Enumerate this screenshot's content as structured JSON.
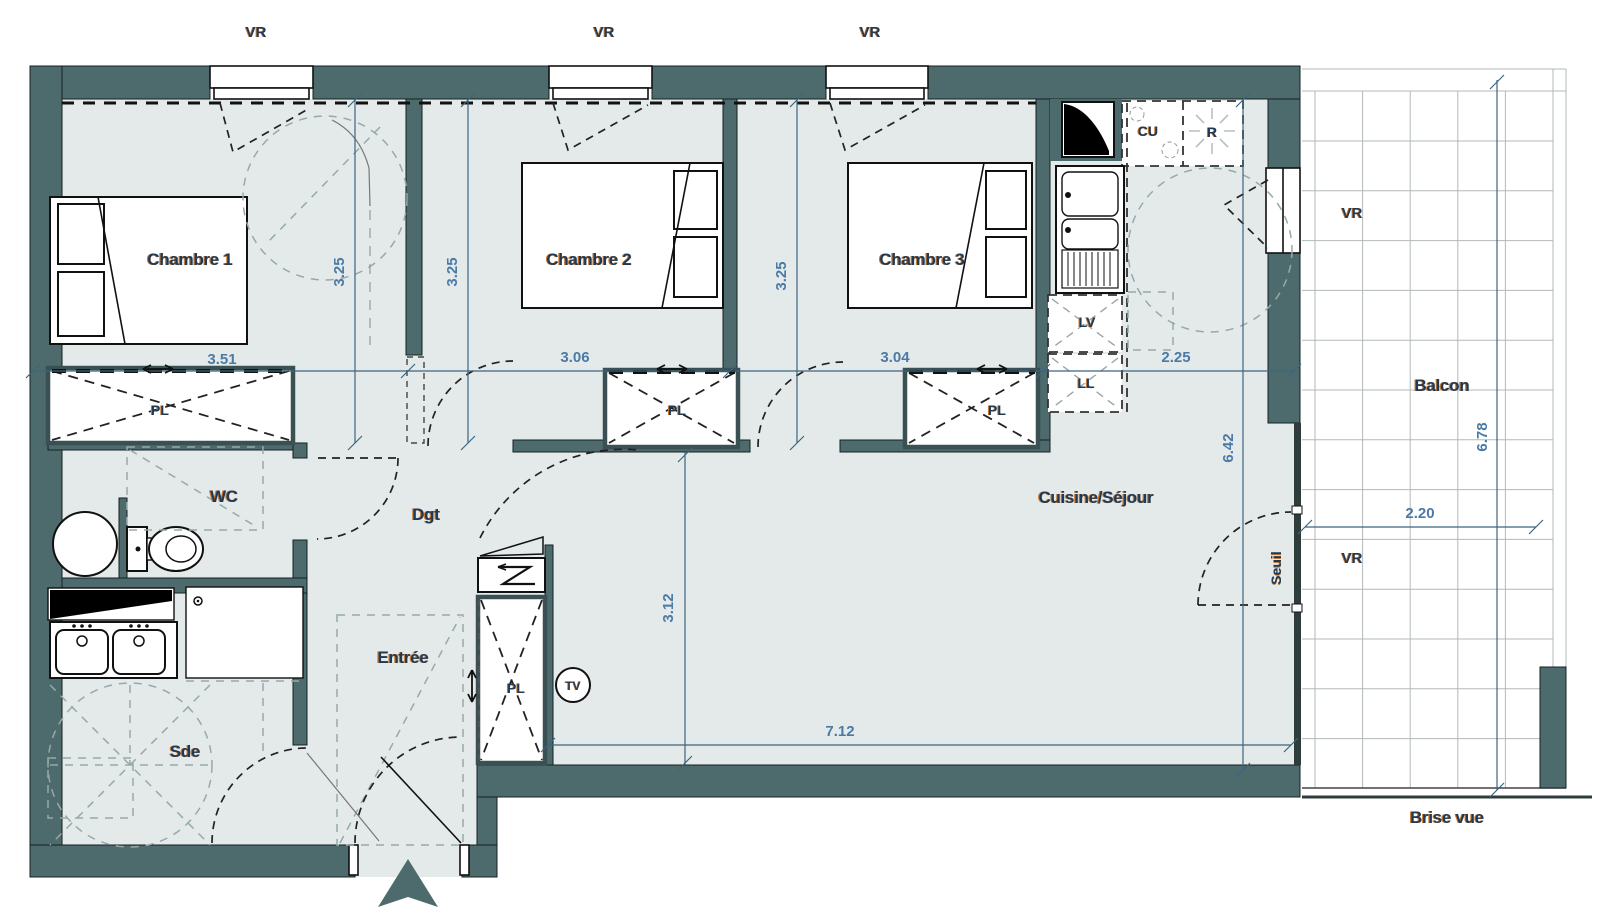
{
  "labels": {
    "vr": "VR",
    "chambre1": "Chambre 1",
    "chambre2": "Chambre 2",
    "chambre3": "Chambre 3",
    "cuisine_sejour": "Cuisine/Séjour",
    "wc": "WC",
    "dgt": "Dgt",
    "entree": "Entrée",
    "sde": "Sde",
    "balcon": "Balcon",
    "brise_vue": "Brise vue",
    "seuil": "Seuil",
    "pl": "PL",
    "cu": "CU",
    "r": "R",
    "lv": "LV",
    "ll": "LL",
    "tv": "TV"
  },
  "dimensions": {
    "chambre1_width": "3.51",
    "chambre2_width": "3.06",
    "chambre3_width": "3.04",
    "kitchen_width": "2.25",
    "chambre1_depth": "3.25",
    "chambre2_depth": "3.25",
    "chambre3_depth": "3.25",
    "sejour_length": "6.42",
    "sejour_depth": "3.12",
    "sejour_width": "7.12",
    "balcon_width": "2.20",
    "balcon_length": "6.78"
  },
  "colors": {
    "wall": "#4d6b6d",
    "floor": "#e4eaea",
    "label_navy": "#1e3a57",
    "label_accent": "#c9782f",
    "dim_blue": "#4a7aa5"
  }
}
